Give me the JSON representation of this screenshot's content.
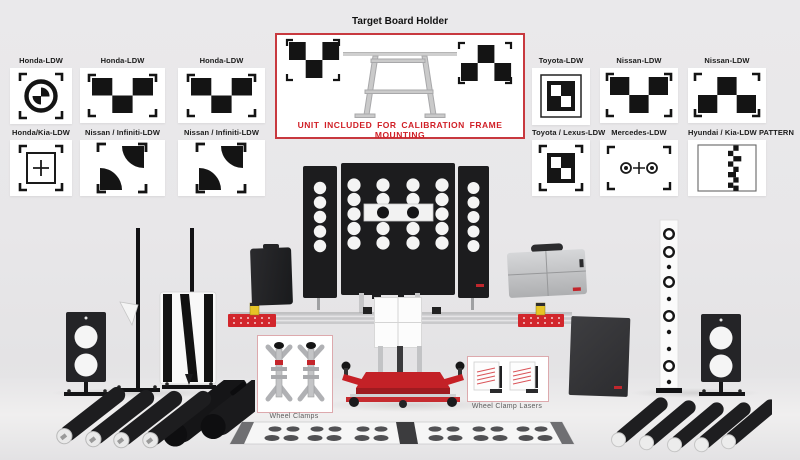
{
  "colors": {
    "background": "#e9e8ea",
    "card_bg": "#ffffff",
    "accent_red": "#cf2127",
    "holder_border": "#c8393f",
    "note_text": "#d01f26",
    "label_text": "#1b1b1b",
    "caption_text": "#5d5d5d",
    "equipment_black": "#1c1c1e",
    "rail_silver": "#c9c9cb",
    "laser_yellow": "#e6c427"
  },
  "holder": {
    "title": "Target Board Holder",
    "note": "UNIT INCLUDED FOR CALIBRATION FRAME MOUNTING"
  },
  "cards": {
    "left": [
      {
        "label": "Honda-LDW",
        "pattern": "circle-quadrant-target"
      },
      {
        "label": "Honda-LDW",
        "pattern": "checkerboard-3x2"
      },
      {
        "label": "Honda-LDW",
        "pattern": "checkerboard-3x2"
      },
      {
        "label": "Honda/Kia-LDW",
        "pattern": "cross-square-target"
      },
      {
        "label": "Nissan / Infiniti-LDW",
        "pattern": "quadrant-corner-target"
      },
      {
        "label": "Nissan / Infiniti-LDW",
        "pattern": "quadrant-corner-target"
      }
    ],
    "right": [
      {
        "label": "Toyota-LDW",
        "pattern": "framed-checker-square"
      },
      {
        "label": "Nissan-LDW",
        "pattern": "checkerboard-3x2"
      },
      {
        "label": "Nissan-LDW",
        "pattern": "checkerboard-3x2-inverted"
      },
      {
        "label": "Toyota / Lexus-LDW",
        "pattern": "framed-checker-square"
      },
      {
        "label": "Mercedes-LDW",
        "pattern": "dots-cross-target"
      },
      {
        "label": "Hyundai / Kia-LDW PATTERN",
        "pattern": "zigzag-strip-pattern"
      }
    ]
  },
  "captions": {
    "wheel_clamps": "Wheel Clamps",
    "wheel_clamp_lasers": "Wheel Clamp Lasers"
  }
}
